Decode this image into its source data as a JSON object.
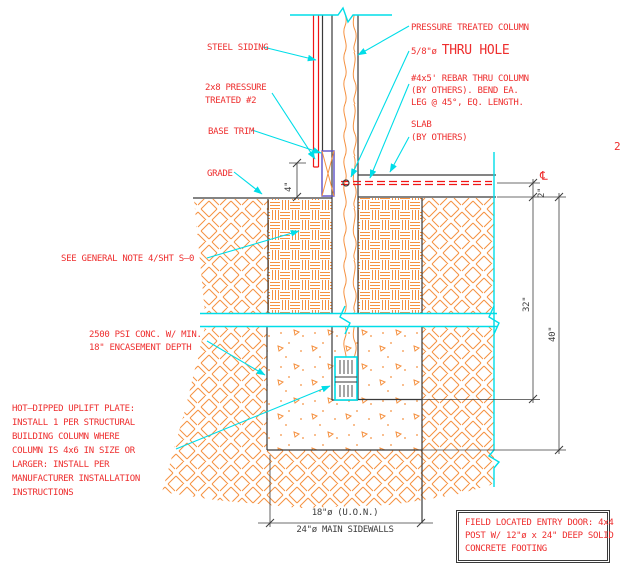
{
  "colors": {
    "red": "#ee2e2e",
    "linered": "#f01515",
    "cyan": "#00dde8",
    "orange": "#f59140",
    "dark": "#3a3a3a",
    "blue": "#5a50c8",
    "dim": "#3c3c3c"
  },
  "labels": {
    "steel_siding": "STEEL SIDING",
    "pressure_2x8": [
      "2x8 PRESSURE",
      "TREATED #2"
    ],
    "base_trim": "BASE TRIM",
    "grade": "GRADE",
    "pressure_treated_column": "PRESSURE TREATED COLUMN",
    "thru_hole_size": "5/8\"ø ",
    "thru_hole": "THRU HOLE",
    "rebar": [
      "#4x5' REBAR THRU COLUMN",
      "(BY OTHERS). BEND EA.",
      "LEG @ 45°, EQ. LENGTH."
    ],
    "slab": [
      "SLAB",
      "(BY OTHERS)"
    ],
    "detail_number": "2",
    "general_note": "SEE GENERAL NOTE 4/SHT S–0",
    "conc": [
      "2500 PSI CONC. W/ MIN.",
      "18\" ENCASEMENT DEPTH"
    ],
    "uplift": [
      "HOT–DIPPED UPLIFT PLATE:",
      "INSTALL 1 PER STRUCTURAL",
      "BUILDING COLUMN WHERE",
      "COLUMN IS 4x6 IN SIZE OR",
      "LARGER: INSTALL PER",
      "MANUFACTURER INSTALLATION",
      "INSTRUCTIONS"
    ],
    "centerline_symbol": "℄"
  },
  "dimensions": {
    "slab_offset": "2\"",
    "encasement_depth": "32\"",
    "footing_depth": "40\"",
    "base_height": "4\"",
    "dia_uon": "18\"ø (U.O.N.)",
    "dia_main": "24\"ø MAIN SIDEWALLS"
  },
  "note_box": {
    "lines": [
      "FIELD LOCATED ENTRY DOOR: 4x4",
      "POST W/ 12\"ø x 24\" DEEP SOLID",
      "CONCRETE FOOTING"
    ]
  }
}
